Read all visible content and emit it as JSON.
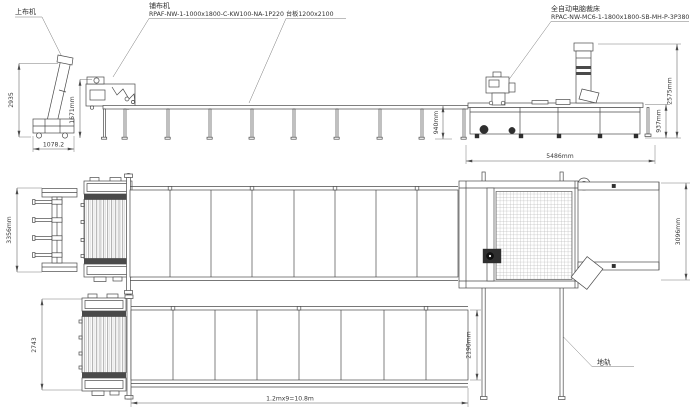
{
  "machines": {
    "loader": {
      "label": "上布机"
    },
    "spreader": {
      "label": "铺布机",
      "model": "RPAF-NW-1-1000x1800-C-KW100-NA-1P220"
    },
    "table": {
      "label": "台板1200x2100"
    },
    "cutter": {
      "label": "全自动电脑裁床",
      "model": "RPAC-NW-MC6-1-1800x1800-SB-MH-P-3P380"
    },
    "rail": {
      "label": "地轨"
    }
  },
  "dims": {
    "loader_height": "2935",
    "loader_base": "1078.2",
    "spreader_height": "1671mm",
    "table_height": "940mm",
    "cutter_length": "5486mm",
    "cutter_table_height": "937mm",
    "cutter_height": "2575mm",
    "top_view_depth": "3356mm",
    "cutter_plan_depth": "3096mm",
    "bottom_view_depth": "2743",
    "rail_span": "2190mm",
    "table_length": "1.2mx9=10.8m"
  },
  "colors": {
    "line": "#4a4a4a",
    "dim_line": "#5a5a5a",
    "text": "#333333",
    "background": "#ffffff"
  }
}
